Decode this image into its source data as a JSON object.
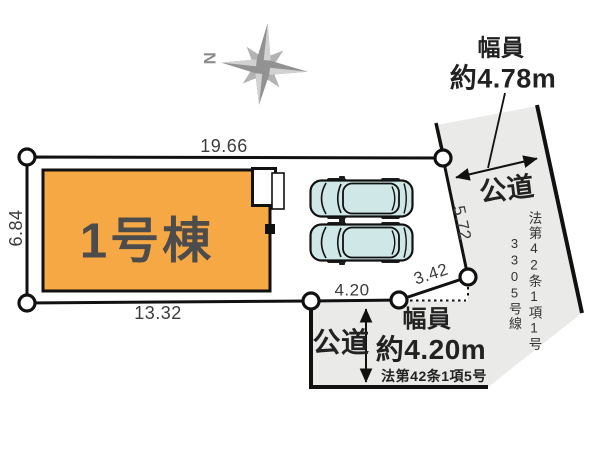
{
  "compass": {
    "north_label": "N"
  },
  "building": {
    "label": "1号棟"
  },
  "dimensions": {
    "top": "19.66",
    "left": "6.84",
    "bottom": "13.32",
    "bottom_mid": "4.20",
    "bottom_slant": "3.42",
    "right": "5.72"
  },
  "road_right": {
    "name": "公道",
    "width_caption": "幅員",
    "width_value": "約4.78m",
    "law_ref": "法第42条1項1号",
    "line_ref": "3305号線"
  },
  "road_bottom": {
    "name": "公道",
    "width_caption": "幅員",
    "width_value": "約4.20m",
    "law_ref": "法第42条1項5号"
  },
  "colors": {
    "building_fill": "#f6a844",
    "road_fill": "#eaeae8",
    "car_fill": "#cfe8e7",
    "line": "#1a1a1a",
    "compass_gray": "#8e8e8e"
  }
}
